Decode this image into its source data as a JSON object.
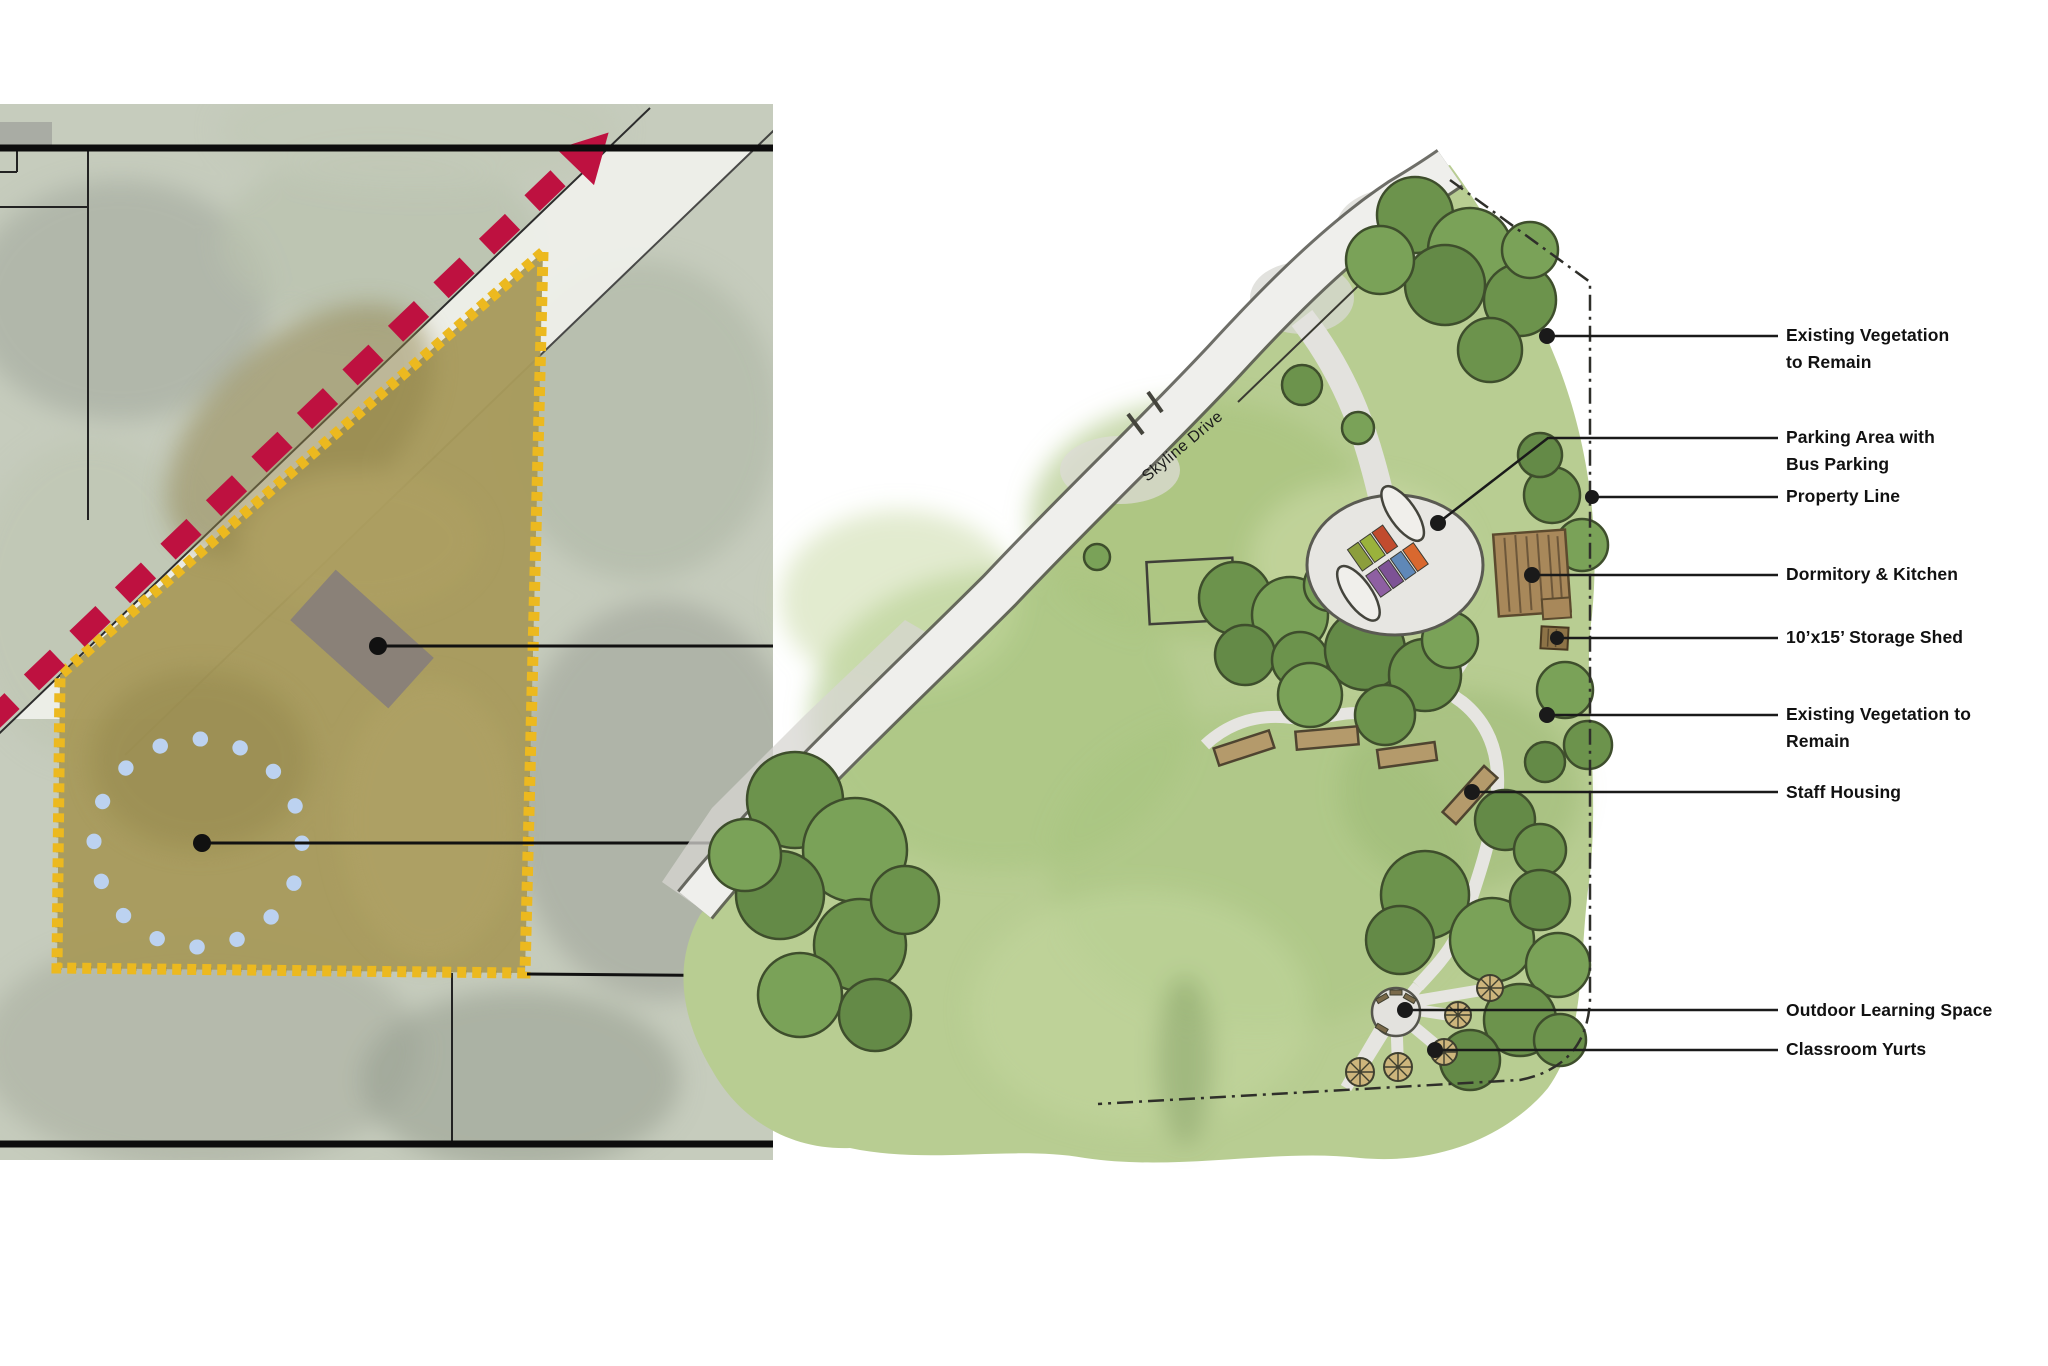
{
  "site_plan": {
    "road_label": "Skyline Drive",
    "callouts": [
      {
        "id": "existing-vegetation-top",
        "text": "Existing Vegetation\nto Remain"
      },
      {
        "id": "parking-area",
        "text": "Parking Area with\nBus Parking"
      },
      {
        "id": "property-line",
        "text": "Property Line"
      },
      {
        "id": "dormitory-kitchen",
        "text": "Dormitory & Kitchen"
      },
      {
        "id": "storage-shed",
        "text": "10’x15’ Storage Shed"
      },
      {
        "id": "existing-vegetation-mid",
        "text": "Existing Vegetation to\nRemain"
      },
      {
        "id": "staff-housing",
        "text": "Staff Housing"
      },
      {
        "id": "outdoor-learning-space",
        "text": "Outdoor Learning Space"
      },
      {
        "id": "classroom-yurts",
        "text": "Classroom Yurts"
      }
    ],
    "colors": {
      "property_boundary": "#ecb91f",
      "road_arrow": "#be1140",
      "dotted_circle": "#bcd2f0",
      "existing_building": "#8a8178",
      "lawn": "#b8cd92",
      "tree_canopy": "#6c934c",
      "wood_building": "#a8885a",
      "callout_line": "#1a1a1a"
    }
  }
}
